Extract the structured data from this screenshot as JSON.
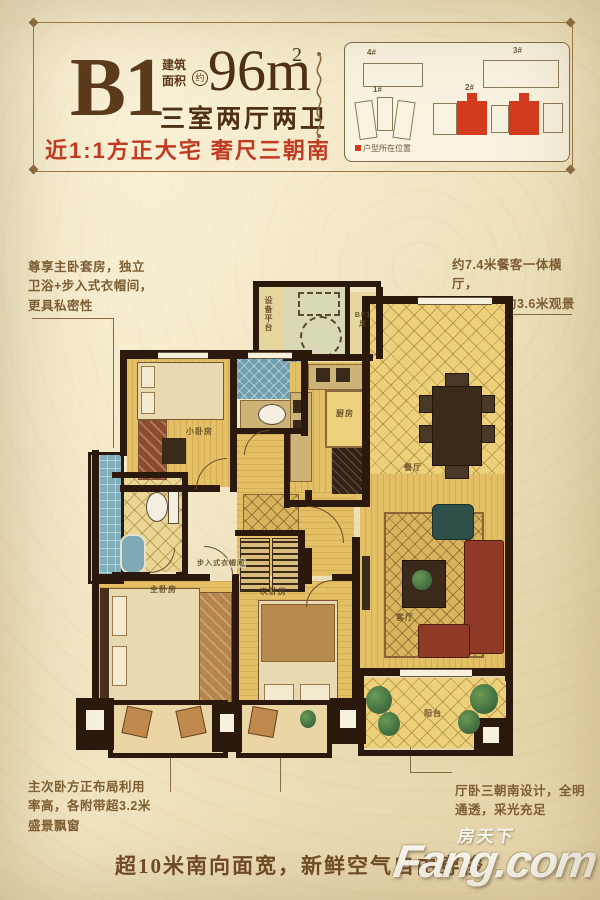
{
  "header": {
    "unit_code": "B1",
    "area_label_line1": "建筑",
    "area_label_line2": "面积",
    "area_circle": "约",
    "area_value": "96m",
    "area_exponent": "2",
    "rooms_summary": "三室两厅两卫",
    "tagline": "近1:1方正大宅  奢尺三朝南"
  },
  "siteplan": {
    "labels": {
      "b4": "4#",
      "b3": "3#",
      "b1": "1#",
      "b2": "2#"
    },
    "legend": "户型所在位置"
  },
  "callouts": {
    "master_suite": {
      "lines": [
        "尊享主卧套房，独立",
        "卫浴+步入式衣帽间，",
        "更具私密性"
      ]
    },
    "dining_hall": {
      "lines": [
        "约7.4米餐客一体横厅，",
        "无缝连接约3.6米观景",
        "大阳台"
      ]
    },
    "bay_windows": {
      "lines": [
        "主次卧方正布局利用",
        "率高，各附带超3.2米",
        "盛景飘窗"
      ]
    },
    "south_facing": {
      "lines": [
        "厅卧三朝南设计，全明",
        "通透，采光充足"
      ]
    }
  },
  "plan_labels": {
    "equipment_platform": "设备平台",
    "shaft": "BF1风",
    "bedroom_small": "小卧房",
    "kitchen": "厨房",
    "dining": "餐厅",
    "living": "客厅",
    "master_bedroom": "主卧房",
    "bedroom_second": "次卧房",
    "walkin_closet": "步入式衣帽间",
    "balcony": "阳台"
  },
  "footer": {
    "slogan": "超10米南向面宽，新鲜空气自由穿梭"
  },
  "watermark": {
    "cn": "房天下",
    "en": "Fang.com"
  },
  "colors": {
    "accent_red": "#c13a22",
    "wall": "#2b190d",
    "floor": "#e3bf66",
    "tile_blue": "#7fafbc"
  }
}
